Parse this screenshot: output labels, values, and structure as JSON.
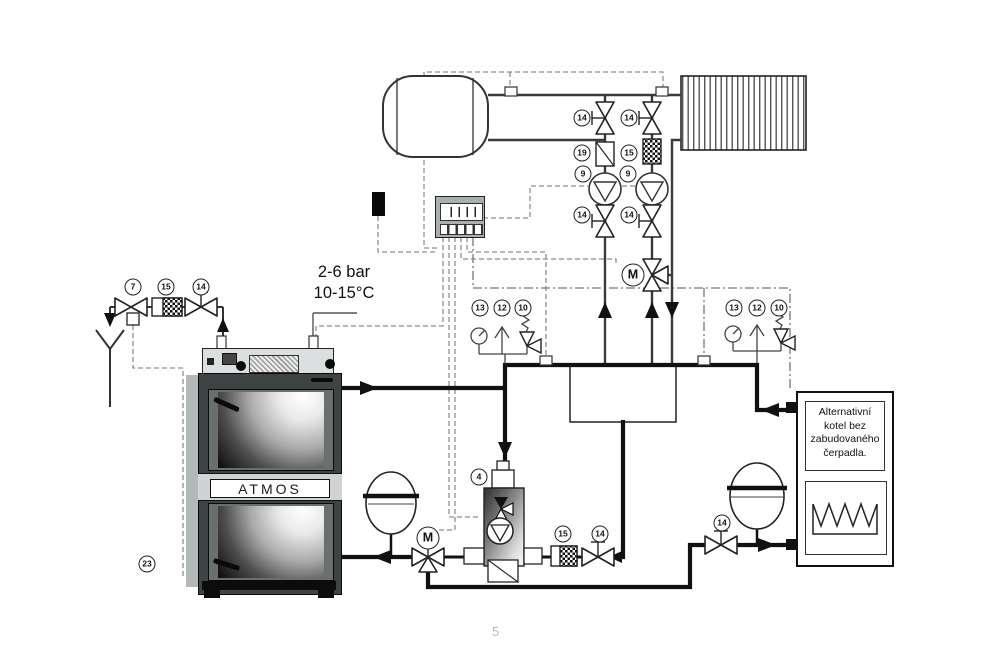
{
  "texts": {
    "pressure_note_line1": "2-6 bar",
    "pressure_note_line2": "10-15°C",
    "boiler_brand": "ATMOS",
    "alt_boiler_note": [
      "Alternativní",
      "kotel bez",
      "zabudovaného",
      "čerpadla."
    ],
    "footer_mark": "5"
  },
  "colors": {
    "pipe_main": "#111111",
    "pipe_secondary": "#3a3a3a",
    "control_wire": "#8f8f8f",
    "boiler_body": "#3e4343",
    "boiler_panel": "#dcdfdf",
    "boiler_band": "#cfd3d3"
  },
  "badges": [
    {
      "label": "7",
      "x": 133,
      "y": 287,
      "name": "relief-valve",
      "type": "num"
    },
    {
      "label": "15",
      "x": 166,
      "y": 287,
      "name": "filter",
      "type": "num"
    },
    {
      "label": "14",
      "x": 201,
      "y": 287,
      "name": "ball-valve",
      "type": "num"
    },
    {
      "label": "14",
      "x": 582,
      "y": 118,
      "name": "ball-valve",
      "type": "num"
    },
    {
      "label": "19",
      "x": 582,
      "y": 153,
      "name": "check-valve",
      "type": "num"
    },
    {
      "label": "9",
      "x": 583,
      "y": 174,
      "name": "pump",
      "type": "num"
    },
    {
      "label": "14",
      "x": 582,
      "y": 215,
      "name": "ball-valve",
      "type": "num"
    },
    {
      "label": "14",
      "x": 629,
      "y": 118,
      "name": "ball-valve",
      "type": "num"
    },
    {
      "label": "15",
      "x": 629,
      "y": 153,
      "name": "filter",
      "type": "num"
    },
    {
      "label": "9",
      "x": 628,
      "y": 174,
      "name": "pump",
      "type": "num"
    },
    {
      "label": "14",
      "x": 629,
      "y": 215,
      "name": "ball-valve",
      "type": "num"
    },
    {
      "label": "13",
      "x": 480,
      "y": 308,
      "name": "pressure-gauge",
      "type": "num"
    },
    {
      "label": "12",
      "x": 502,
      "y": 308,
      "name": "thermometer",
      "type": "num"
    },
    {
      "label": "10",
      "x": 523,
      "y": 308,
      "name": "safety-valve",
      "type": "num"
    },
    {
      "label": "13",
      "x": 734,
      "y": 308,
      "name": "pressure-gauge",
      "type": "num"
    },
    {
      "label": "12",
      "x": 757,
      "y": 308,
      "name": "thermometer",
      "type": "num"
    },
    {
      "label": "10",
      "x": 779,
      "y": 308,
      "name": "safety-valve",
      "type": "num"
    },
    {
      "label": "4",
      "x": 479,
      "y": 477,
      "name": "laddomat-unit",
      "type": "num"
    },
    {
      "label": "15",
      "x": 563,
      "y": 534,
      "name": "filter",
      "type": "num"
    },
    {
      "label": "14",
      "x": 600,
      "y": 534,
      "name": "ball-valve",
      "type": "num"
    },
    {
      "label": "14",
      "x": 722,
      "y": 523,
      "name": "ball-valve",
      "type": "num"
    },
    {
      "label": "23",
      "x": 147,
      "y": 564,
      "name": "label-23",
      "type": "num"
    },
    {
      "label": "M",
      "x": 633,
      "y": 275,
      "name": "mixing-valve-motor",
      "type": "motor"
    },
    {
      "label": "M",
      "x": 428,
      "y": 538,
      "name": "mixing-valve-motor",
      "type": "motor"
    }
  ]
}
